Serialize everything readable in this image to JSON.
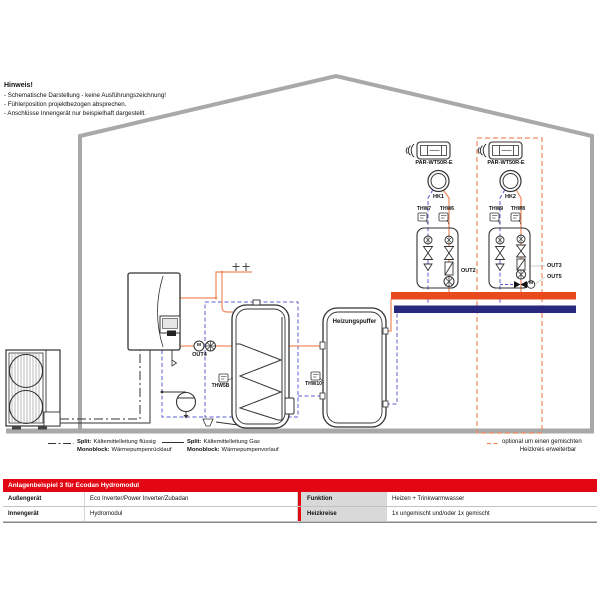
{
  "hinweis": {
    "title": "Hinweis!",
    "line1": "- Schematische Darstellung - keine Ausführungszeichnung!",
    "line2": "- Fühlerposition projektbezogen absprechen.",
    "line3": "- Anschlüsse Innengerät nur beispielhaft dargestellt."
  },
  "controllers": {
    "c1": {
      "remote": "PAR-WT50R-E",
      "circuit": "HK1",
      "sensor_left": "THW7",
      "sensor_right": "THW6"
    },
    "c2": {
      "remote": "PAR-WT50R-E",
      "circuit": "HK2",
      "sensor_left": "THW9",
      "sensor_right": "THW8"
    }
  },
  "labels": {
    "out2": "OUT2",
    "out3": "OUT3",
    "out4": "OUT4",
    "out5": "OUT5",
    "thw5b": "THW5B",
    "thw10": "THW10",
    "buffer_tank": "Heizungspuffer",
    "motor": "M"
  },
  "optional_note": {
    "line1": "optional um einen gemischten",
    "line2": "Heizkreis erweiterbar"
  },
  "legend": {
    "e1": {
      "k1": "Split:",
      "v1": "Kältemittelleitung flüssig",
      "k2": "Monoblock:",
      "v2": "Wärmepumpenrücklauf"
    },
    "e2": {
      "k1": "Split:",
      "v1": "Kältemittelleitung Gas",
      "k2": "Monoblock:",
      "v2": "Wärmepumpenvorlauf"
    }
  },
  "table": {
    "header": "Anlagenbeispiel 3 für Ecodan Hydromodul",
    "r1": {
      "label": "Außengerät",
      "value": "Eco Inverter/Power Inverter/Zubadan",
      "label2": "Funktion",
      "value2": "Heizen + Trinkwarmwasser"
    },
    "r2": {
      "label": "Innengerät",
      "value": "Hydromodul",
      "label2": "Heizkreise",
      "value2": "1x ungemischt und/oder 1x gemischt"
    }
  },
  "colors": {
    "brand_red": "#e30613",
    "pipe_flow_orange": "#f08a5c",
    "pipe_return_blue": "#5c5cd0",
    "bar_flow": "#e8491d",
    "bar_return": "#28287e",
    "house_gray": "#a9a9a9"
  }
}
